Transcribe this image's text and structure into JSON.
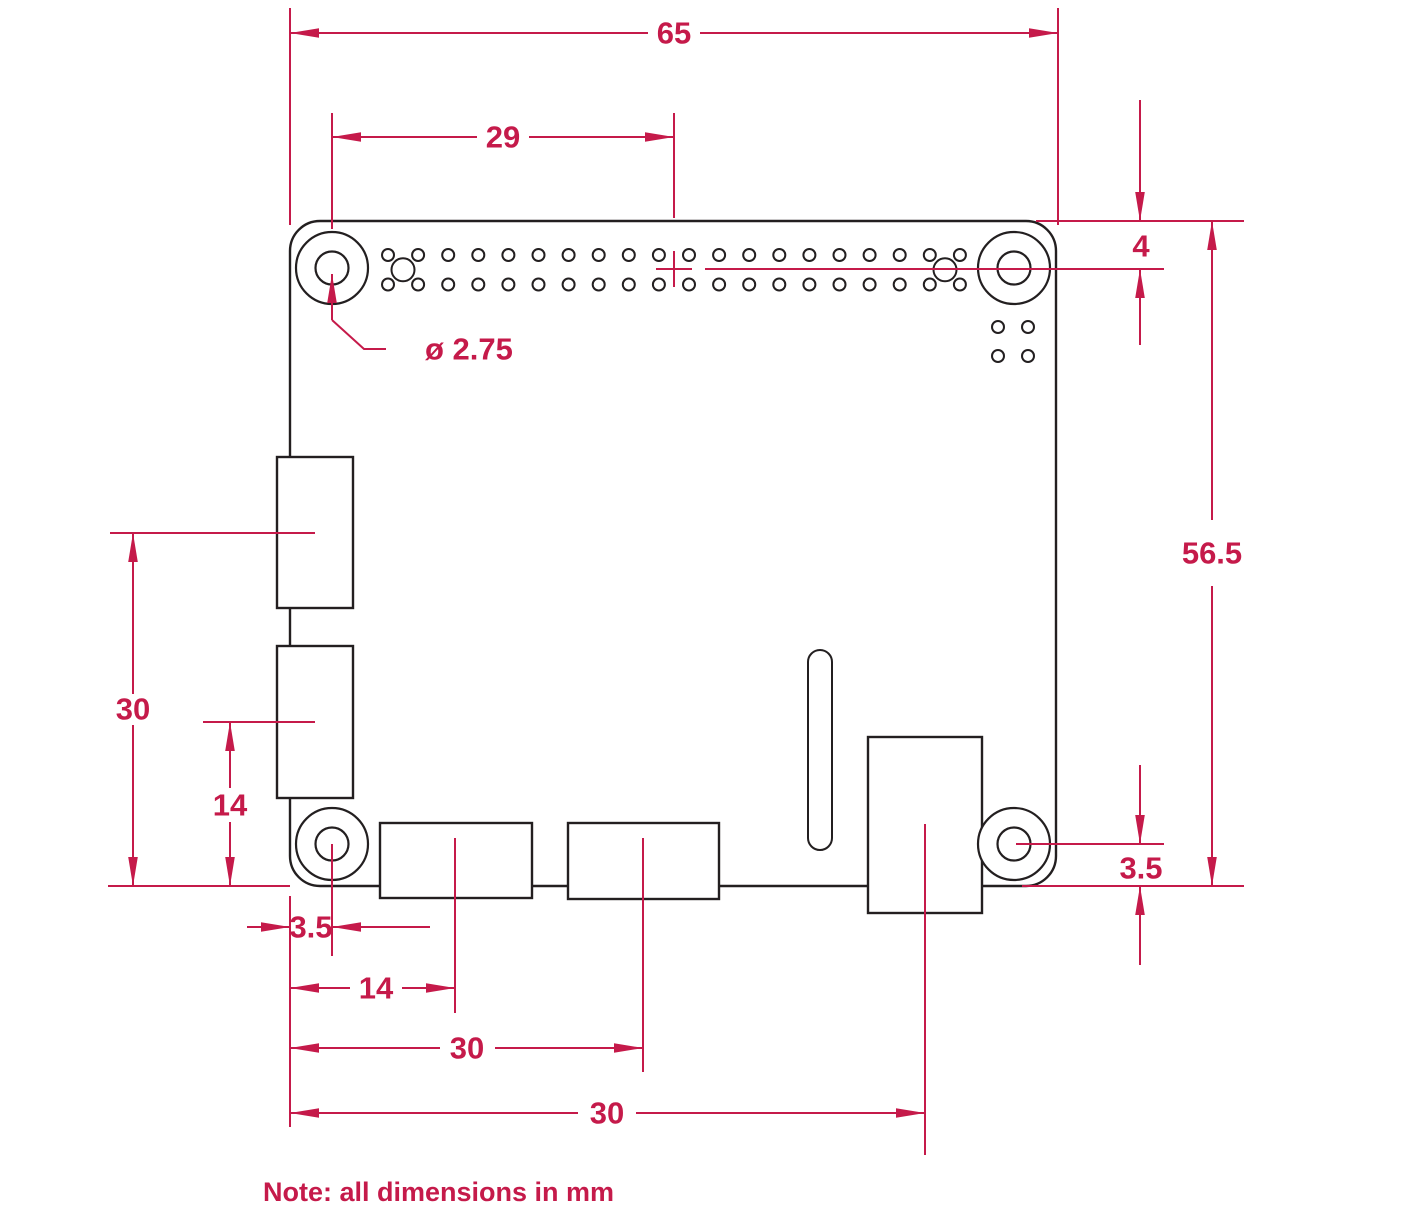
{
  "drawing": {
    "subject": "single-board-computer-mechanical-drawing",
    "units": "mm"
  },
  "colors": {
    "dimension": "#c51a4a",
    "outline": "#231f20",
    "background": "#ffffff"
  },
  "dimensions": {
    "board_width": "65",
    "gpio_center_from_hole": "29",
    "hole_center_from_top": "4",
    "board_height": "56.5",
    "mount_hole_diameter": "ø 2.75",
    "hole_center_from_bottom_right": "3.5",
    "left_connector_1_center": "30",
    "left_connector_2_center": "14",
    "hole_center_from_left": "3.5",
    "bottom_connector_1_center": "14",
    "bottom_connector_2_center": "30",
    "power_connector_center": "30"
  },
  "note": "Note: all dimensions in mm"
}
